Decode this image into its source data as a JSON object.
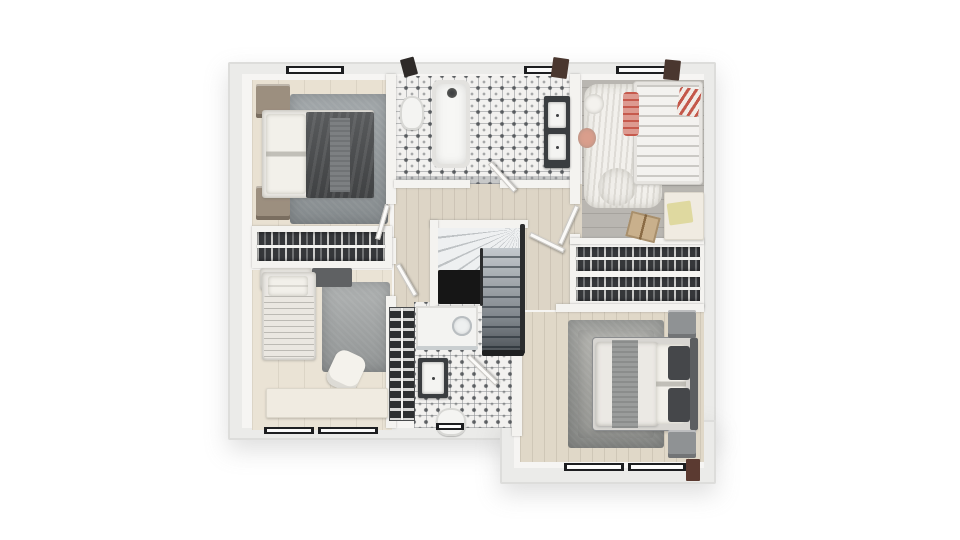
{
  "meta": {
    "title": "3D rendered upper-floor house plan, top-down view",
    "canvas": {
      "width": 960,
      "height": 540
    },
    "background": "#ffffff"
  },
  "palette": {
    "wall_shell": "#ebebe9",
    "wall_inner": "#f6f5f3",
    "floor_beige": "#e9e1d2",
    "floor_hall": "#ddd5c6",
    "floor_master": "#e0d8c8",
    "floor_nursery_gray": "#b9b6b1",
    "tile_base": "#f2f1ef",
    "rug_gray": "#9aa0a3",
    "duvet_dark": "#4e5052",
    "closet_dark": "#35373a",
    "void_black": "#161616",
    "window_frame": "#1d1e20",
    "accent_pink": "#dd9a90",
    "accent_red": "#c4584a",
    "accent_wood_red": "#5b3a31"
  },
  "rooms": [
    {
      "name": "bedroom-top-left"
    },
    {
      "name": "closet-left"
    },
    {
      "name": "bedroom-bottom-left"
    },
    {
      "name": "bathroom-main"
    },
    {
      "name": "nursery"
    },
    {
      "name": "hall-landing"
    },
    {
      "name": "dressing-closet"
    },
    {
      "name": "master-bedroom"
    },
    {
      "name": "bathroom-ensuite"
    },
    {
      "name": "staircase"
    }
  ],
  "elements": [
    {
      "name": "building-shell-main",
      "cls": "wall-shell",
      "x": 228,
      "y": 62,
      "w": 488,
      "h": 378
    },
    {
      "name": "building-shell-extension",
      "cls": "wall-shell",
      "x": 500,
      "y": 420,
      "w": 216,
      "h": 64
    },
    {
      "name": "interior-wall-base",
      "cls": "wall-inner",
      "x": 242,
      "y": 74,
      "w": 462,
      "h": 354
    },
    {
      "name": "interior-wall-base-ext",
      "cls": "wall-inner",
      "x": 514,
      "y": 420,
      "w": 190,
      "h": 48
    },
    {
      "name": "bedroom1-floor",
      "cls": "floor-wood",
      "x": 252,
      "y": 80,
      "w": 138,
      "h": 148,
      "color": "#e9e1d2"
    },
    {
      "name": "bedroom2-floor",
      "cls": "floor-wood",
      "x": 252,
      "y": 270,
      "w": 140,
      "h": 160,
      "color": "#eae3d5"
    },
    {
      "name": "bathroom-main-floor",
      "cls": "floor-tile",
      "x": 394,
      "y": 76,
      "w": 178,
      "h": 108
    },
    {
      "name": "bathroom-main-tile-border",
      "cls": "soft",
      "x": 394,
      "y": 176,
      "w": 178,
      "h": 8,
      "color": "rgba(120,124,128,0.35)"
    },
    {
      "name": "hall-floor",
      "cls": "floor-wood-v",
      "x": 394,
      "y": 184,
      "w": 188,
      "h": 126,
      "color": "#ddd5c6"
    },
    {
      "name": "nursery-floor",
      "cls": "floor-wood-h",
      "x": 582,
      "y": 80,
      "w": 122,
      "h": 162,
      "color": "#b9b6b1"
    },
    {
      "name": "dressing-closet-base",
      "cls": "wall-part",
      "x": 570,
      "y": 242,
      "w": 134,
      "h": 66
    },
    {
      "name": "master-floor",
      "cls": "floor-wood-v",
      "x": 520,
      "y": 312,
      "w": 184,
      "h": 150,
      "color": "#e0d8c8"
    },
    {
      "name": "bathroom-ensuite-floor",
      "cls": "floor-tile",
      "x": 414,
      "y": 302,
      "w": 104,
      "h": 126
    },
    {
      "name": "bedroom1-rug",
      "cls": "rug",
      "x": 290,
      "y": 94,
      "w": 98,
      "h": 130,
      "color": "#9aa0a3"
    },
    {
      "name": "bedroom2-rug",
      "cls": "rug",
      "x": 322,
      "y": 282,
      "w": 68,
      "h": 90,
      "color": "#a7aaaa"
    },
    {
      "name": "master-rug",
      "cls": "rug",
      "x": 568,
      "y": 320,
      "w": 96,
      "h": 128,
      "color": "#9c9d99"
    },
    {
      "name": "master-rug-center",
      "cls": "rug",
      "x": 578,
      "y": 330,
      "w": 76,
      "h": 108,
      "color": "#adada8"
    },
    {
      "name": "nursery-rug",
      "cls": "rug-fluffy",
      "x": 584,
      "y": 84,
      "w": 78,
      "h": 124,
      "color": "#f2f0ec"
    },
    {
      "name": "nursery-rug-blob",
      "cls": "rug-fluffy",
      "x": 598,
      "y": 168,
      "w": 38,
      "h": 38,
      "color": "#f0eeea",
      "rad": "50%"
    },
    {
      "name": "wall-left-vertical-upper",
      "cls": "wall-part",
      "x": 386,
      "y": 74,
      "w": 10,
      "h": 130
    },
    {
      "name": "wall-left-vertical-mid",
      "cls": "wall-part",
      "x": 386,
      "y": 238,
      "w": 10,
      "h": 26
    },
    {
      "name": "wall-left-vertical-lower",
      "cls": "wall-part",
      "x": 386,
      "y": 296,
      "w": 10,
      "h": 132
    },
    {
      "name": "wall-bathroom-main-bottom-left",
      "cls": "wall-part",
      "x": 394,
      "y": 180,
      "w": 76,
      "h": 8
    },
    {
      "name": "wall-bathroom-main-bottom-right",
      "cls": "wall-part",
      "x": 500,
      "y": 180,
      "w": 72,
      "h": 8
    },
    {
      "name": "wall-nursery-left-upper",
      "cls": "wall-part",
      "x": 570,
      "y": 74,
      "w": 10,
      "h": 130
    },
    {
      "name": "wall-nursery-left-stub",
      "cls": "wall-part",
      "x": 570,
      "y": 234,
      "w": 10,
      "h": 10
    },
    {
      "name": "wall-nursery-closet",
      "cls": "wall-part",
      "x": 570,
      "y": 238,
      "w": 134,
      "h": 6
    },
    {
      "name": "wall-closet-master",
      "cls": "wall-part",
      "x": 556,
      "y": 304,
      "w": 148,
      "h": 8
    },
    {
      "name": "wall-ensuite-master",
      "cls": "wall-part",
      "x": 512,
      "y": 350,
      "w": 10,
      "h": 86
    },
    {
      "name": "closet-left-frame",
      "cls": "wall-part",
      "x": 252,
      "y": 226,
      "w": 140,
      "h": 42
    },
    {
      "name": "stairs-top-wall",
      "cls": "wall-part",
      "x": 430,
      "y": 220,
      "w": 98,
      "h": 8
    },
    {
      "name": "stairs-left-wall",
      "cls": "wall-part",
      "x": 430,
      "y": 220,
      "w": 8,
      "h": 92
    },
    {
      "name": "stairs-winders",
      "cls": "winders",
      "x": 438,
      "y": 228,
      "w": 82,
      "h": 42
    },
    {
      "name": "stairs-void-opening",
      "cls": "soft",
      "x": 438,
      "y": 270,
      "w": 44,
      "h": 34,
      "color": "#161616"
    },
    {
      "name": "stairs-flight",
      "cls": "flight",
      "x": 482,
      "y": 248,
      "w": 38,
      "h": 104
    },
    {
      "name": "stairs-rail-right",
      "cls": "soft",
      "x": 520,
      "y": 224,
      "w": 5,
      "h": 130,
      "color": "#2b2c2d"
    },
    {
      "name": "stairs-rail-mid",
      "cls": "soft",
      "x": 480,
      "y": 248,
      "w": 3,
      "h": 58,
      "color": "#2b2c2d"
    },
    {
      "name": "stairs-bottom-edge",
      "cls": "soft",
      "x": 482,
      "y": 350,
      "w": 42,
      "h": 6,
      "color": "#1f2021"
    },
    {
      "name": "stairs-under-wall",
      "cls": "wall-part",
      "x": 436,
      "y": 306,
      "w": 46,
      "h": 6
    },
    {
      "name": "closet-left-clothes",
      "cls": "clothes",
      "x": 257,
      "y": 232,
      "w": 128,
      "h": 29
    },
    {
      "name": "closet-left-rail",
      "cls": "rail",
      "x": 257,
      "y": 245,
      "w": 128,
      "h": 3
    },
    {
      "name": "dressing-clothes-row1",
      "cls": "clothes",
      "x": 576,
      "y": 247,
      "w": 124,
      "h": 24
    },
    {
      "name": "dressing-rail-row1",
      "cls": "rail",
      "x": 576,
      "y": 257,
      "w": 124,
      "h": 3
    },
    {
      "name": "dressing-clothes-row2",
      "cls": "clothes",
      "x": 576,
      "y": 277,
      "w": 124,
      "h": 24
    },
    {
      "name": "dressing-rail-row2",
      "cls": "rail",
      "x": 576,
      "y": 287,
      "w": 124,
      "h": 3
    },
    {
      "name": "bedroom1-nightstand-top",
      "cls": "wood",
      "x": 256,
      "y": 84,
      "w": 34,
      "h": 34
    },
    {
      "name": "bedroom1-nightstand-bottom",
      "cls": "wood",
      "x": 256,
      "y": 186,
      "w": 34,
      "h": 34
    },
    {
      "name": "bedroom1-bed-mattress",
      "cls": "bed-white",
      "x": 262,
      "y": 110,
      "w": 112,
      "h": 88
    },
    {
      "name": "bedroom1-pillows",
      "cls": "pillow",
      "x": 266,
      "y": 114,
      "w": 40,
      "h": 80
    },
    {
      "name": "bedroom1-duvet",
      "cls": "duvet-dark",
      "x": 306,
      "y": 112,
      "w": 68,
      "h": 86
    },
    {
      "name": "bedroom1-blanket-fold",
      "cls": "throw",
      "x": 330,
      "y": 118,
      "w": 20,
      "h": 74,
      "color": "#7d8082"
    },
    {
      "name": "bedroom2-cabinet",
      "cls": "bed-white",
      "x": 260,
      "y": 268,
      "w": 52,
      "h": 22
    },
    {
      "name": "bedroom2-bench",
      "cls": "soft",
      "x": 312,
      "y": 268,
      "w": 40,
      "h": 19,
      "color": "#5f6163"
    },
    {
      "name": "bedroom2-bed",
      "cls": "bed-white",
      "x": 262,
      "y": 272,
      "w": 54,
      "h": 88
    },
    {
      "name": "bedroom2-pillow",
      "cls": "pillow",
      "x": 268,
      "y": 276,
      "w": 40,
      "h": 20
    },
    {
      "name": "bedroom2-blanket",
      "cls": "blanket-stripes",
      "x": 264,
      "y": 296,
      "w": 50,
      "h": 62
    },
    {
      "name": "bedroom2-chair",
      "cls": "chair",
      "x": 330,
      "y": 352,
      "w": 32,
      "h": 38,
      "rot": 25
    },
    {
      "name": "bedroom2-desk",
      "cls": "desk",
      "x": 266,
      "y": 388,
      "w": 122,
      "h": 30
    },
    {
      "name": "bathtub",
      "cls": "tub",
      "x": 432,
      "y": 80,
      "w": 38,
      "h": 88
    },
    {
      "name": "bath-fixture",
      "cls": "round",
      "x": 447,
      "y": 88,
      "w": 10,
      "h": 10,
      "color": "#3e4042"
    },
    {
      "name": "toilet-main",
      "cls": "toilet",
      "x": 400,
      "y": 96,
      "w": 24,
      "h": 34
    },
    {
      "name": "vanity-double",
      "cls": "vanity",
      "x": 544,
      "y": 96,
      "w": 26,
      "h": 72
    },
    {
      "name": "vanity-sink-1",
      "cls": "sink-basin",
      "x": 548,
      "y": 102,
      "w": 18,
      "h": 26
    },
    {
      "name": "vanity-sink-2",
      "cls": "sink-basin",
      "x": 548,
      "y": 134,
      "w": 18,
      "h": 26
    },
    {
      "name": "crib",
      "cls": "crib",
      "x": 634,
      "y": 82,
      "w": 68,
      "h": 102
    },
    {
      "name": "crib-blanket-roll",
      "cls": "pink-roll",
      "x": 623,
      "y": 92,
      "w": 16,
      "h": 44
    },
    {
      "name": "crib-striped-pillow",
      "cls": "stripes-red",
      "x": 678,
      "y": 88,
      "w": 22,
      "h": 28,
      "rot": 8
    },
    {
      "name": "nursery-pouf-pink",
      "cls": "round",
      "x": 578,
      "y": 128,
      "w": 18,
      "h": 20,
      "color": "#d99e8c"
    },
    {
      "name": "nursery-pouf-white",
      "cls": "round",
      "x": 584,
      "y": 94,
      "w": 20,
      "h": 20,
      "color": "#f4f2ee"
    },
    {
      "name": "nursery-desk",
      "cls": "desk",
      "x": 664,
      "y": 192,
      "w": 40,
      "h": 48
    },
    {
      "name": "nursery-book",
      "cls": "soft",
      "x": 668,
      "y": 202,
      "w": 24,
      "h": 22,
      "color": "#dfd9a0",
      "rot": -8
    },
    {
      "name": "nursery-cardboard-box",
      "cls": "box",
      "x": 628,
      "y": 214,
      "w": 30,
      "h": 26,
      "rot": 14
    },
    {
      "name": "master-bed-frame",
      "cls": "bed-frame",
      "x": 593,
      "y": 338,
      "w": 104,
      "h": 92
    },
    {
      "name": "master-duvet",
      "cls": "bed-white",
      "x": 596,
      "y": 342,
      "w": 62,
      "h": 84
    },
    {
      "name": "master-throw",
      "cls": "throw",
      "x": 612,
      "y": 340,
      "w": 26,
      "h": 88
    },
    {
      "name": "master-pillows-white",
      "cls": "pillow",
      "x": 656,
      "y": 344,
      "w": 30,
      "h": 80
    },
    {
      "name": "master-pillow-dark-1",
      "cls": "soft",
      "x": 668,
      "y": 346,
      "w": 22,
      "h": 34,
      "color": "#45474a",
      "rad": "3px"
    },
    {
      "name": "master-pillow-dark-2",
      "cls": "soft",
      "x": 668,
      "y": 388,
      "w": 22,
      "h": 34,
      "color": "#45474a",
      "rad": "3px"
    },
    {
      "name": "master-headboard",
      "cls": "soft",
      "x": 690,
      "y": 338,
      "w": 8,
      "h": 92,
      "color": "#5c5e60"
    },
    {
      "name": "master-nightstand-top",
      "cls": "gray-cube",
      "x": 668,
      "y": 310,
      "w": 28,
      "h": 28
    },
    {
      "name": "master-nightstand-bottom",
      "cls": "gray-cube",
      "x": 668,
      "y": 430,
      "w": 28,
      "h": 28
    },
    {
      "name": "ensuite-towel-shelf",
      "cls": "towel-shelf",
      "x": 390,
      "y": 308,
      "w": 24,
      "h": 112
    },
    {
      "name": "ensuite-shelf-divider",
      "cls": "rail",
      "x": 401,
      "y": 308,
      "w": 2,
      "h": 112
    },
    {
      "name": "ensuite-shower-tray",
      "cls": "shower",
      "x": 416,
      "y": 306,
      "w": 62,
      "h": 42
    },
    {
      "name": "ensuite-shower-drain",
      "cls": "drain",
      "x": 452,
      "y": 316,
      "w": 20,
      "h": 20
    },
    {
      "name": "ensuite-shower-glass",
      "cls": "soft",
      "x": 416,
      "y": 346,
      "w": 62,
      "h": 4,
      "color": "#c9ced0"
    },
    {
      "name": "ensuite-sink-frame",
      "cls": "vanity",
      "x": 418,
      "y": 358,
      "w": 30,
      "h": 40
    },
    {
      "name": "ensuite-sink-basin",
      "cls": "sink-basin",
      "x": 422,
      "y": 362,
      "w": 22,
      "h": 32
    },
    {
      "name": "ensuite-toilet",
      "cls": "toilet",
      "x": 436,
      "y": 408,
      "w": 30,
      "h": 28
    },
    {
      "name": "door-bedroom1",
      "cls": "door",
      "x": 380,
      "y": 204,
      "w": 5,
      "h": 36,
      "rot": 16
    },
    {
      "name": "door-bedroom2",
      "cls": "door",
      "x": 404,
      "y": 262,
      "w": 5,
      "h": 36,
      "rot": -30
    },
    {
      "name": "door-bathroom-main",
      "cls": "door",
      "x": 500,
      "y": 158,
      "w": 5,
      "h": 38,
      "rot": -42
    },
    {
      "name": "door-nursery",
      "cls": "door",
      "x": 566,
      "y": 204,
      "w": 5,
      "h": 42,
      "rot": 24
    },
    {
      "name": "door-master",
      "cls": "door",
      "x": 528,
      "y": 240,
      "w": 38,
      "h": 5,
      "rot": 26
    },
    {
      "name": "door-bathroom-ensuite",
      "cls": "door",
      "x": 480,
      "y": 350,
      "w": 5,
      "h": 40,
      "rot": -46
    },
    {
      "name": "window-top-bedroom1",
      "cls": "window-h",
      "x": 286,
      "y": 66,
      "w": 58,
      "h": 8
    },
    {
      "name": "window-top-bathroom",
      "cls": "window-h",
      "x": 524,
      "y": 66,
      "w": 34,
      "h": 8
    },
    {
      "name": "window-top-nursery",
      "cls": "window-h",
      "x": 616,
      "y": 66,
      "w": 56,
      "h": 8
    },
    {
      "name": "window-shade-left",
      "cls": "wood-dark",
      "x": 402,
      "y": 58,
      "w": 14,
      "h": 18,
      "rot": -15
    },
    {
      "name": "window-shade-mid",
      "cls": "wood-brown",
      "x": 552,
      "y": 58,
      "w": 16,
      "h": 20,
      "rot": 8
    },
    {
      "name": "window-shade-right",
      "cls": "wood-brown",
      "x": 664,
      "y": 60,
      "w": 16,
      "h": 20,
      "rot": 6
    },
    {
      "name": "window-bottom-bedroom2-a",
      "cls": "window-h",
      "x": 264,
      "y": 427,
      "w": 50,
      "h": 7
    },
    {
      "name": "window-bottom-bedroom2-b",
      "cls": "window-h",
      "x": 318,
      "y": 427,
      "w": 60,
      "h": 7
    },
    {
      "name": "window-bottom-ensuite",
      "cls": "window-h",
      "x": 436,
      "y": 423,
      "w": 28,
      "h": 7
    },
    {
      "name": "window-bottom-master-a",
      "cls": "window-h",
      "x": 564,
      "y": 463,
      "w": 60,
      "h": 8
    },
    {
      "name": "window-bottom-master-b",
      "cls": "window-h",
      "x": 628,
      "y": 463,
      "w": 58,
      "h": 8
    },
    {
      "name": "window-post-master",
      "cls": "wood-red",
      "x": 686,
      "y": 459,
      "w": 14,
      "h": 22
    }
  ]
}
